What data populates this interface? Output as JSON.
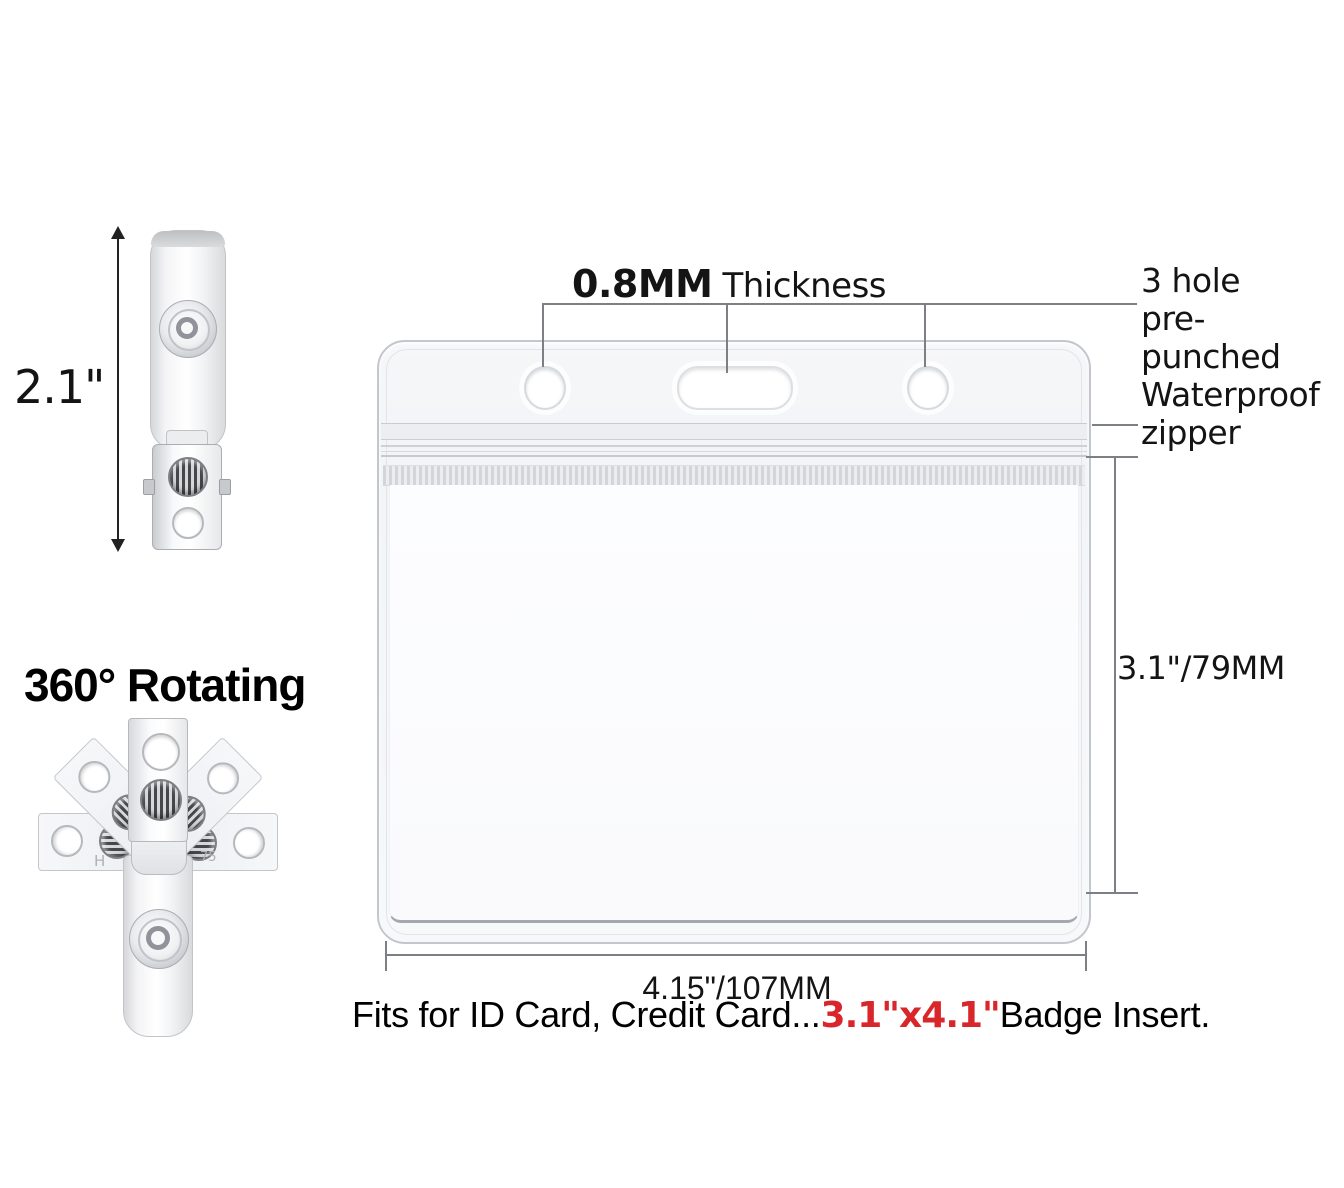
{
  "figures": {
    "strap_clip": {
      "height_label": "2.1\""
    },
    "rotating_clip": {
      "title": "360° Rotating",
      "stamp_left": "H",
      "stamp_right": "75"
    }
  },
  "holder": {
    "thickness": {
      "value": "0.8MM",
      "label": "Thickness"
    },
    "holes_note": {
      "line1": "3 hole",
      "line2": "pre-punched"
    },
    "zipper_note": {
      "line1": "Waterproof",
      "line2": "zipper"
    },
    "height_label": "3.1\"/79MM",
    "width_label": "4.15\"/107MM"
  },
  "caption": {
    "prefix": "Fits for ID Card, Credit Card...",
    "highlight": "3.1\"x4.1\"",
    "suffix": "Badge Insert."
  },
  "colors": {
    "highlight_red": "#d9262b",
    "dimension_gray": "#7c7f84",
    "arrow_black": "#222222"
  }
}
